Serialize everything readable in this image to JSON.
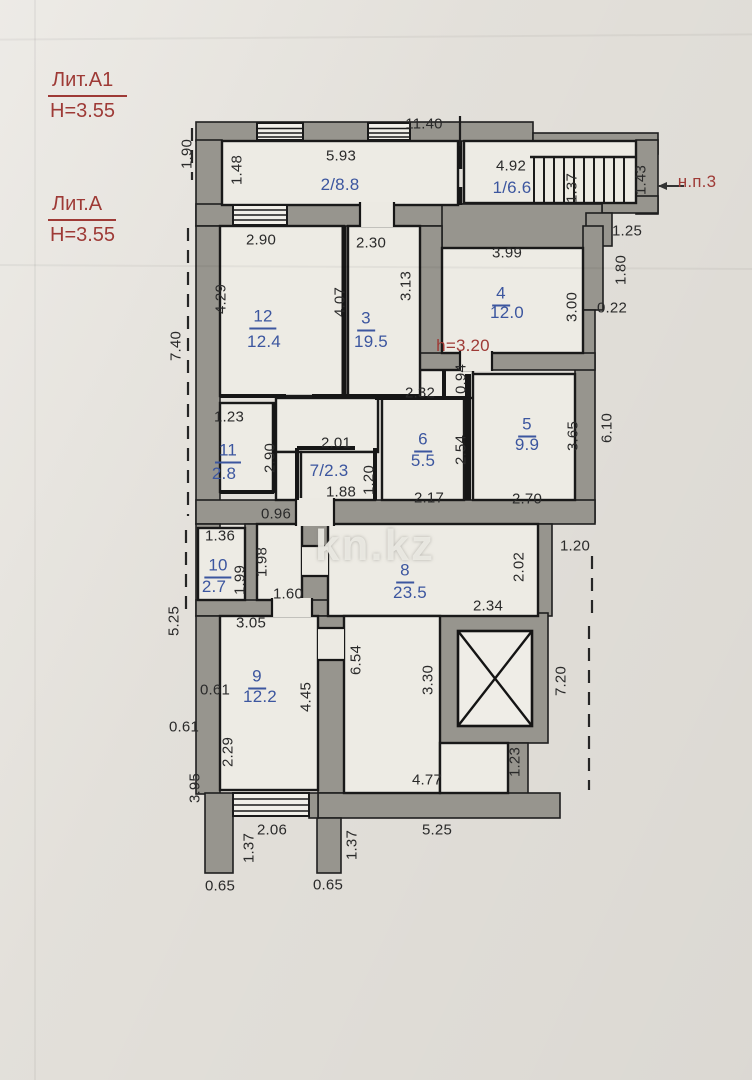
{
  "colors": {
    "room_label_blue": "#3c569f",
    "note_red": "#9e3a36",
    "wall_gray": "#97958e",
    "paper": "#e7e4de"
  },
  "watermark": "kn.kz",
  "legend": [
    {
      "title": "Лит.А1",
      "sub": "Н=3.55"
    },
    {
      "title": "Лит.А",
      "sub": "Н=3.55"
    }
  ],
  "rooms_summary": [
    {
      "id": "1",
      "area": "6.6"
    },
    {
      "id": "2",
      "area": "8.8"
    },
    {
      "id": "3",
      "area": "19.5"
    },
    {
      "id": "4",
      "area": "12.0"
    },
    {
      "id": "5",
      "area": "9.9"
    },
    {
      "id": "6",
      "area": "5.5"
    },
    {
      "id": "7",
      "area": "2.3"
    },
    {
      "id": "8",
      "area": "23.5"
    },
    {
      "id": "9",
      "area": "12.2"
    },
    {
      "id": "10",
      "area": "2.7"
    },
    {
      "id": "11",
      "area": "2.8"
    },
    {
      "id": "12",
      "area": "12.4"
    }
  ],
  "labels": [
    {
      "n": "room-2-label",
      "t": "2/8.8",
      "x": 340,
      "y": 185,
      "c": "rline"
    },
    {
      "n": "room-1-label",
      "t": "1/6.6",
      "x": 512,
      "y": 188,
      "c": "rline"
    },
    {
      "n": "room-7-label",
      "t": "7/2.3",
      "x": 329,
      "y": 471,
      "c": "rline"
    },
    {
      "n": "room-12-number",
      "t": "12",
      "x": 263,
      "y": 318,
      "c": "rnum"
    },
    {
      "n": "room-12-area",
      "t": "12.4",
      "x": 264,
      "y": 342,
      "c": "rarea"
    },
    {
      "n": "room-3-number",
      "t": "3",
      "x": 366,
      "y": 320,
      "c": "rnum"
    },
    {
      "n": "room-3-area",
      "t": "19.5",
      "x": 371,
      "y": 342,
      "c": "rarea"
    },
    {
      "n": "room-4-number",
      "t": "4",
      "x": 501,
      "y": 295,
      "c": "rnum"
    },
    {
      "n": "room-4-area",
      "t": "12.0",
      "x": 507,
      "y": 313,
      "c": "rarea"
    },
    {
      "n": "room-5-number",
      "t": "5",
      "x": 527,
      "y": 426,
      "c": "rnum"
    },
    {
      "n": "room-5-area",
      "t": "9.9",
      "x": 527,
      "y": 445,
      "c": "rarea"
    },
    {
      "n": "room-6-number",
      "t": "6",
      "x": 423,
      "y": 441,
      "c": "rnum"
    },
    {
      "n": "room-6-area",
      "t": "5.5",
      "x": 423,
      "y": 461,
      "c": "rarea"
    },
    {
      "n": "room-8-number",
      "t": "8",
      "x": 405,
      "y": 572,
      "c": "rnum"
    },
    {
      "n": "room-8-area",
      "t": "23.5",
      "x": 410,
      "y": 593,
      "c": "rarea"
    },
    {
      "n": "room-9-number",
      "t": "9",
      "x": 257,
      "y": 678,
      "c": "rnum"
    },
    {
      "n": "room-9-area",
      "t": "12.2",
      "x": 260,
      "y": 697,
      "c": "rarea"
    },
    {
      "n": "room-10-number",
      "t": "10",
      "x": 218,
      "y": 567,
      "c": "rnum"
    },
    {
      "n": "room-10-area",
      "t": "2.7",
      "x": 214,
      "y": 587,
      "c": "rarea"
    },
    {
      "n": "room-11-number",
      "t": "11",
      "x": 228,
      "y": 452,
      "c": "rnum"
    },
    {
      "n": "room-11-area",
      "t": "2.8",
      "x": 224,
      "y": 474,
      "c": "rarea"
    },
    {
      "n": "note-np3",
      "t": "н.п.3",
      "x": 697,
      "y": 182,
      "c": "red"
    },
    {
      "n": "note-ceiling-height",
      "t": "h=3.20",
      "x": 463,
      "y": 346,
      "c": "red"
    },
    {
      "n": "watermark",
      "t": "kn.kz",
      "x": 375,
      "y": 546,
      "c": "wm"
    },
    {
      "n": "dim",
      "t": "11.40",
      "x": 424,
      "y": 124
    },
    {
      "n": "dim",
      "t": "5.93",
      "x": 341,
      "y": 156
    },
    {
      "n": "dim",
      "t": "1.48",
      "x": 237,
      "y": 170,
      "r": -90
    },
    {
      "n": "dim",
      "t": "1.90",
      "x": 187,
      "y": 154,
      "r": -90
    },
    {
      "n": "dim",
      "t": "4.92",
      "x": 511,
      "y": 166
    },
    {
      "n": "dim",
      "t": "1.37",
      "x": 572,
      "y": 188,
      "r": -90
    },
    {
      "n": "dim",
      "t": "1.43",
      "x": 641,
      "y": 180,
      "r": -90
    },
    {
      "n": "dim",
      "t": "1.25",
      "x": 627,
      "y": 231
    },
    {
      "n": "dim",
      "t": "1.80",
      "x": 621,
      "y": 270,
      "r": -90
    },
    {
      "n": "dim",
      "t": "0.22",
      "x": 612,
      "y": 308
    },
    {
      "n": "dim",
      "t": "2.90",
      "x": 261,
      "y": 240
    },
    {
      "n": "dim",
      "t": "2.30",
      "x": 371,
      "y": 243
    },
    {
      "n": "dim",
      "t": "3.99",
      "x": 507,
      "y": 253
    },
    {
      "n": "dim",
      "t": "4.29",
      "x": 221,
      "y": 299,
      "r": -90
    },
    {
      "n": "dim",
      "t": "4.07",
      "x": 340,
      "y": 302,
      "r": -90
    },
    {
      "n": "dim",
      "t": "3.13",
      "x": 406,
      "y": 286,
      "r": -90
    },
    {
      "n": "dim",
      "t": "3.00",
      "x": 572,
      "y": 307,
      "r": -90
    },
    {
      "n": "dim",
      "t": "7.40",
      "x": 176,
      "y": 346,
      "r": -90
    },
    {
      "n": "dim",
      "t": "6.10",
      "x": 607,
      "y": 428,
      "r": -90
    },
    {
      "n": "dim",
      "t": "1.23",
      "x": 229,
      "y": 417
    },
    {
      "n": "dim",
      "t": "2.90",
      "x": 270,
      "y": 458,
      "r": -90
    },
    {
      "n": "dim",
      "t": "2.01",
      "x": 336,
      "y": 443
    },
    {
      "n": "dim",
      "t": "1.88",
      "x": 341,
      "y": 492
    },
    {
      "n": "dim",
      "t": "1.20",
      "x": 369,
      "y": 480,
      "r": -90
    },
    {
      "n": "dim",
      "t": "2.32",
      "x": 420,
      "y": 393
    },
    {
      "n": "dim",
      "t": "0.94",
      "x": 461,
      "y": 379,
      "r": -90
    },
    {
      "n": "dim",
      "t": "2.54",
      "x": 461,
      "y": 450,
      "r": -90
    },
    {
      "n": "dim",
      "t": "2.17",
      "x": 429,
      "y": 498
    },
    {
      "n": "dim",
      "t": "3.65",
      "x": 573,
      "y": 436,
      "r": -90
    },
    {
      "n": "dim",
      "t": "2.70",
      "x": 527,
      "y": 499
    },
    {
      "n": "dim",
      "t": "0.96",
      "x": 276,
      "y": 514
    },
    {
      "n": "dim",
      "t": "1.20",
      "x": 575,
      "y": 546
    },
    {
      "n": "dim",
      "t": "1.36",
      "x": 220,
      "y": 536
    },
    {
      "n": "dim",
      "t": "1.98",
      "x": 262,
      "y": 562,
      "r": -90
    },
    {
      "n": "dim",
      "t": "1.99",
      "x": 240,
      "y": 580,
      "r": -90
    },
    {
      "n": "dim",
      "t": "1.60",
      "x": 288,
      "y": 594
    },
    {
      "n": "dim",
      "t": "3.05",
      "x": 251,
      "y": 623
    },
    {
      "n": "dim",
      "t": "5.25",
      "x": 174,
      "y": 621,
      "r": -90
    },
    {
      "n": "dim",
      "t": "2.02",
      "x": 519,
      "y": 567,
      "r": -90
    },
    {
      "n": "dim",
      "t": "2.34",
      "x": 488,
      "y": 606
    },
    {
      "n": "dim",
      "t": "0.61",
      "x": 215,
      "y": 690
    },
    {
      "n": "dim",
      "t": "0.61",
      "x": 184,
      "y": 727
    },
    {
      "n": "dim",
      "t": "2.29",
      "x": 228,
      "y": 752,
      "r": -90
    },
    {
      "n": "dim",
      "t": "4.45",
      "x": 306,
      "y": 697,
      "r": -90
    },
    {
      "n": "dim",
      "t": "6.54",
      "x": 356,
      "y": 660,
      "r": -90
    },
    {
      "n": "dim",
      "t": "3.30",
      "x": 428,
      "y": 680,
      "r": -90
    },
    {
      "n": "dim",
      "t": "7.20",
      "x": 561,
      "y": 681,
      "r": -90
    },
    {
      "n": "dim",
      "t": "1.23",
      "x": 515,
      "y": 762,
      "r": -90
    },
    {
      "n": "dim",
      "t": "4.77",
      "x": 427,
      "y": 780
    },
    {
      "n": "dim",
      "t": "5.25",
      "x": 437,
      "y": 830
    },
    {
      "n": "dim",
      "t": "2.06",
      "x": 272,
      "y": 830
    },
    {
      "n": "dim",
      "t": "1.37",
      "x": 249,
      "y": 848,
      "r": -90
    },
    {
      "n": "dim",
      "t": "1.37",
      "x": 352,
      "y": 845,
      "r": -90
    },
    {
      "n": "dim",
      "t": "0.65",
      "x": 220,
      "y": 886
    },
    {
      "n": "dim",
      "t": "0.65",
      "x": 328,
      "y": 885
    },
    {
      "n": "dim",
      "t": "3.95",
      "x": 195,
      "y": 788,
      "r": -90
    }
  ]
}
